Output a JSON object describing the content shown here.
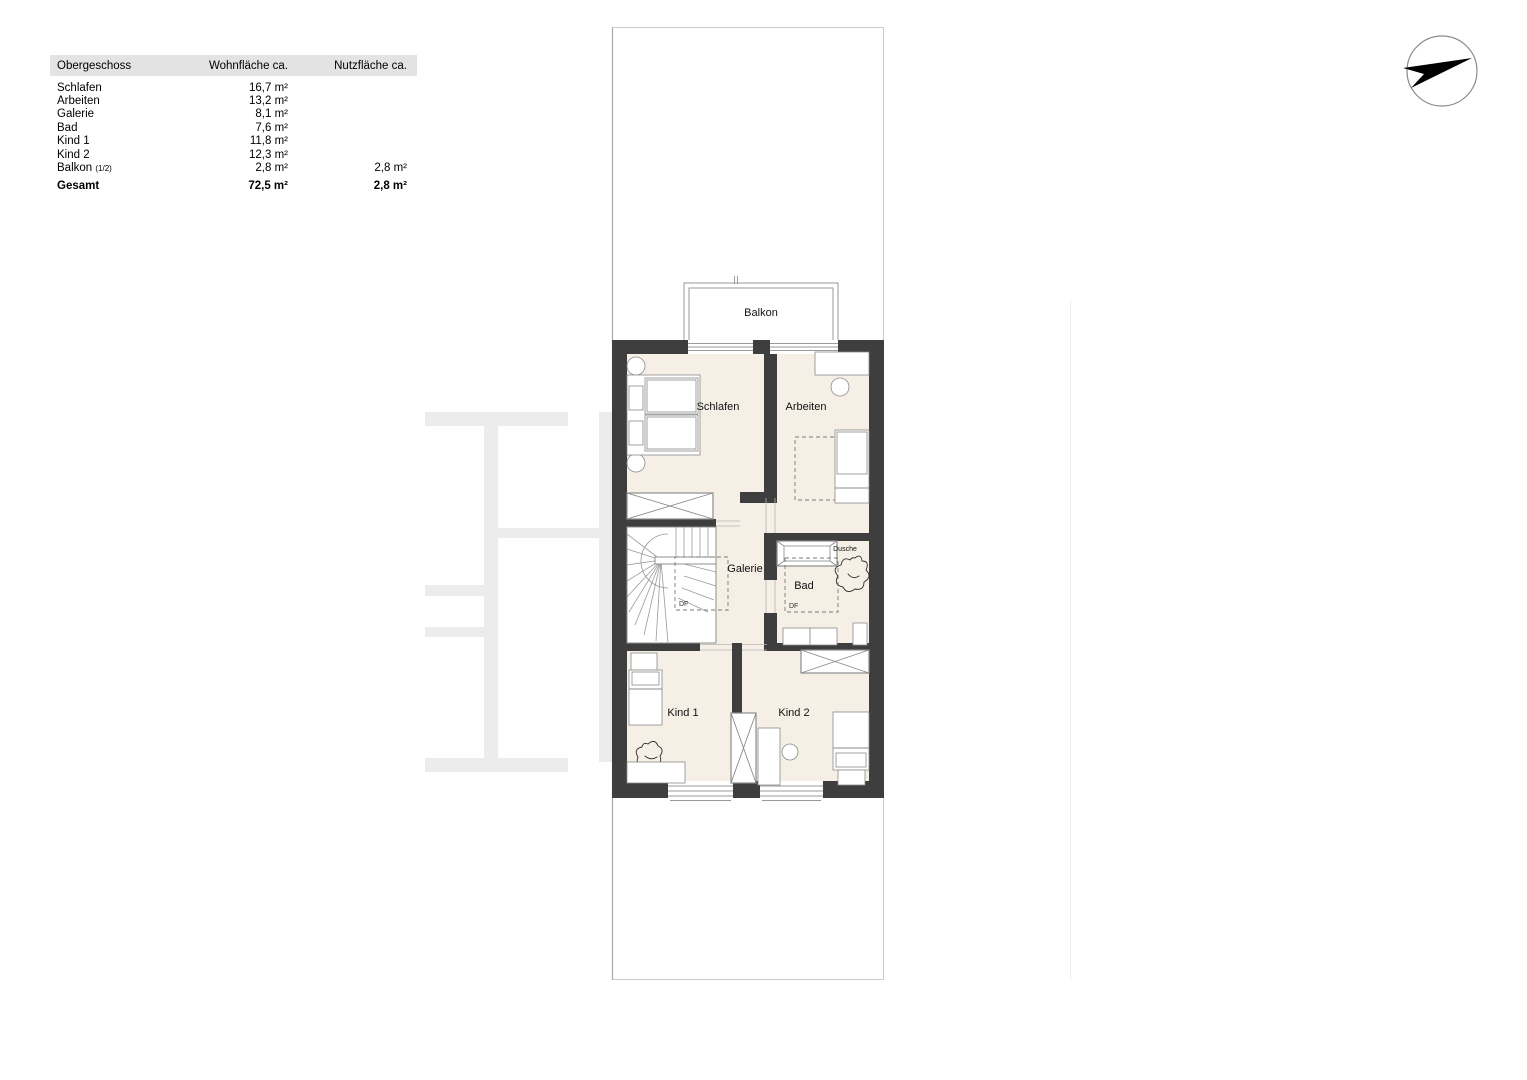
{
  "meta": {
    "colors": {
      "wall": "#3e3e3e",
      "room_fill": "#f5efe6",
      "table_header_bg": "#e3e3e3"
    }
  },
  "table": {
    "header": {
      "col1": "Obergeschoss",
      "col2": "Wohnfläche ca.",
      "col3": "Nutzfläche ca."
    },
    "rows": [
      {
        "label": "Schlafen",
        "wohnflaeche": "16,7 m²",
        "nutzflaeche": ""
      },
      {
        "label": "Arbeiten",
        "wohnflaeche": "13,2 m²",
        "nutzflaeche": ""
      },
      {
        "label": "Galerie",
        "wohnflaeche": "8,1 m²",
        "nutzflaeche": ""
      },
      {
        "label": "Bad",
        "wohnflaeche": "7,6 m²",
        "nutzflaeche": ""
      },
      {
        "label": "Kind 1",
        "wohnflaeche": "11,8 m²",
        "nutzflaeche": ""
      },
      {
        "label": "Kind 2",
        "wohnflaeche": "12,3 m²",
        "nutzflaeche": ""
      },
      {
        "label": "Balkon",
        "label_suffix": "(1/2)",
        "wohnflaeche": "2,8 m²",
        "nutzflaeche": "2,8 m²"
      }
    ],
    "total": {
      "label": "Gesamt",
      "wohnflaeche": "72,5 m²",
      "nutzflaeche": "2,8 m²"
    }
  },
  "floorplan": {
    "labels": {
      "balkon": "Balkon",
      "schlafen": "Schlafen",
      "arbeiten": "Arbeiten",
      "galerie": "Galerie",
      "bad": "Bad",
      "dusche": "Dusche",
      "df_galerie": "DF",
      "df_bad": "DF",
      "kind1": "Kind 1",
      "kind2": "Kind 2"
    }
  }
}
